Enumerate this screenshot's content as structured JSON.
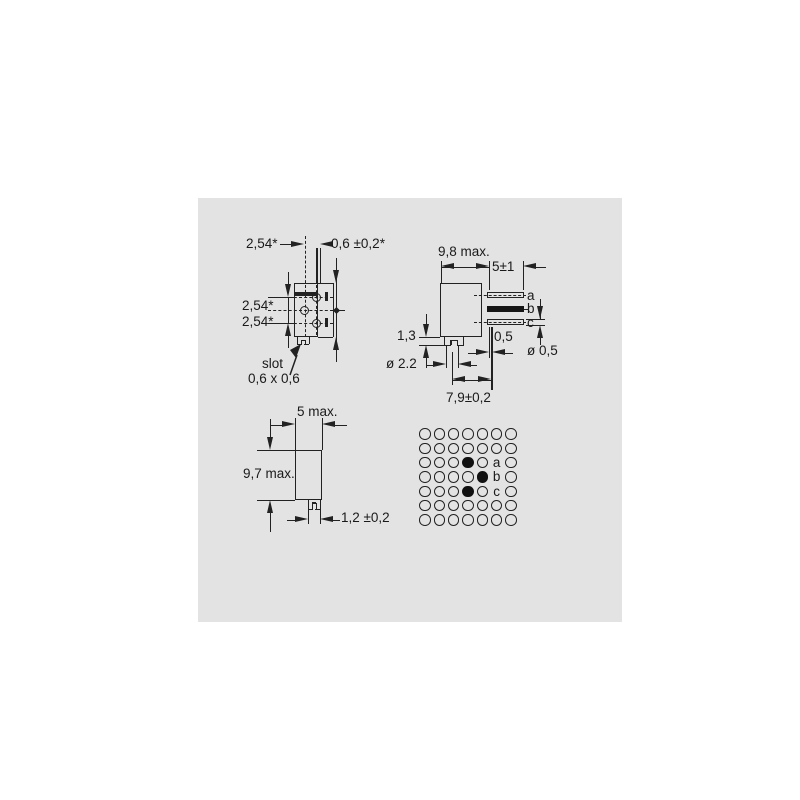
{
  "colors": {
    "page_bg": "#ffffff",
    "panel_bg": "#e3e3e3",
    "line": "#222222",
    "text": "#1a1a1a"
  },
  "front_view": {
    "dim_col_pitch": "2,54*",
    "dim_pin_width": "0,6 ±0,2*",
    "dim_row_pitch_top": "2,54*",
    "dim_row_pitch_bottom": "2,54*",
    "slot_label": "slot",
    "slot_size": "0,6 x 0,6"
  },
  "side_view": {
    "dim_body_depth": "9,8 max.",
    "dim_pin_length": "5±1",
    "pin_a": "a",
    "pin_b": "b",
    "pin_c": "c",
    "dim_standoff_height": "1,3",
    "dim_pin_offset": "0,5",
    "dim_pin_diameter": "ø 0,5",
    "dim_boss_diameter": "ø 2.2",
    "dim_mount_distance": "7,9±0,2"
  },
  "bottom_view": {
    "dim_width": "5 max.",
    "dim_height": "9,7 max.",
    "dim_tab_width": "1,2 ±0,2"
  },
  "hole_grid": {
    "rows": 7,
    "cols": 7,
    "filled_cells": [
      {
        "row": 2,
        "col": 3
      },
      {
        "row": 3,
        "col": 4
      },
      {
        "row": 4,
        "col": 3
      }
    ],
    "label_cells": [
      {
        "row": 2,
        "col": 5,
        "text": "a"
      },
      {
        "row": 3,
        "col": 5,
        "text": "b"
      },
      {
        "row": 4,
        "col": 5,
        "text": "c"
      }
    ]
  }
}
